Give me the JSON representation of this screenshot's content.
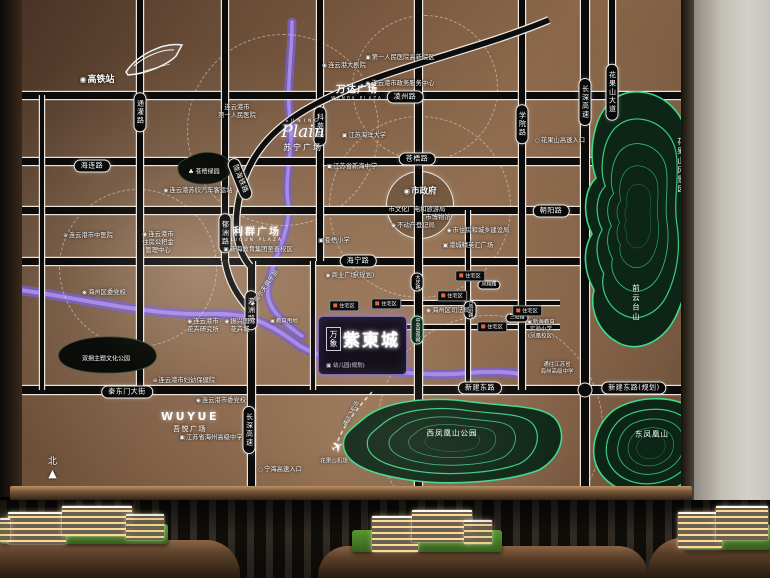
{
  "map": {
    "zone_label": "住宅区",
    "project": {
      "brand": "万象",
      "name": "紫東城",
      "note": "▣ 幼儿园(规划)"
    },
    "logos": {
      "suning": {
        "en": "SUNING",
        "script": "Plain",
        "cn": "苏宁广场"
      },
      "wanda": {
        "cn": "万达广场",
        "en": "WANDA PLAZA"
      },
      "liqun": {
        "cn": "利群广场",
        "en": "LIQUN PLAZA"
      },
      "wuyue": {
        "en": "WUYUE",
        "cn": "吾悦广场"
      }
    },
    "compass": {
      "north": "北"
    },
    "roads": {
      "h": [
        {
          "y": 95,
          "x1": 0,
          "x2": 694,
          "w": 7
        },
        {
          "y": 161,
          "x1": 0,
          "x2": 694,
          "w": 7
        },
        {
          "y": 210,
          "x1": 0,
          "x2": 694,
          "w": 7
        },
        {
          "y": 261,
          "x1": 0,
          "x2": 694,
          "w": 7
        },
        {
          "y": 390,
          "x1": 0,
          "x2": 694,
          "w": 8
        },
        {
          "y": 303,
          "x1": 396,
          "x2": 560,
          "w": 4
        },
        {
          "y": 327,
          "x1": 396,
          "x2": 560,
          "w": 4
        }
      ],
      "v": [
        {
          "x": 42,
          "y1": 95,
          "y2": 390,
          "w": 4
        },
        {
          "x": 140,
          "y1": 0,
          "y2": 390,
          "w": 6
        },
        {
          "x": 225,
          "y1": 0,
          "y2": 261,
          "w": 6
        },
        {
          "x": 251,
          "y1": 261,
          "y2": 497,
          "w": 7
        },
        {
          "x": 313,
          "y1": 261,
          "y2": 390,
          "w": 4
        },
        {
          "x": 320,
          "y1": 0,
          "y2": 261,
          "w": 6
        },
        {
          "x": 418,
          "y1": 0,
          "y2": 497,
          "w": 7
        },
        {
          "x": 468,
          "y1": 210,
          "y2": 390,
          "w": 4
        },
        {
          "x": 522,
          "y1": 0,
          "y2": 390,
          "w": 6
        },
        {
          "x": 585,
          "y1": 0,
          "y2": 497,
          "w": 8
        },
        {
          "x": 612,
          "y1": 0,
          "y2": 205,
          "w": 6
        }
      ]
    },
    "junctions": [
      {
        "x": 585,
        "y": 390
      }
    ],
    "rings": [
      {
        "cx": 283,
        "cy": 130,
        "r": 95
      },
      {
        "cx": 420,
        "cy": 207,
        "r": 90
      },
      {
        "cx": 490,
        "cy": 428,
        "r": 112
      },
      {
        "cx": 138,
        "cy": 268,
        "r": 78
      },
      {
        "cx": 425,
        "cy": 88,
        "r": 72
      }
    ],
    "gov_ring": {
      "cx": 420,
      "cy": 205,
      "r": 33
    },
    "pills": [
      {
        "t": "凌州路",
        "x": 405,
        "y": 97,
        "o": "h"
      },
      {
        "t": "海连路",
        "x": 92,
        "y": 166,
        "o": "h"
      },
      {
        "t": "苍梧路",
        "x": 417,
        "y": 159,
        "o": "h"
      },
      {
        "t": "朝阳路",
        "x": 551,
        "y": 211,
        "o": "h"
      },
      {
        "t": "海宁路",
        "x": 358,
        "y": 261,
        "o": "h"
      },
      {
        "t": "秦东门大街",
        "x": 127,
        "y": 392,
        "o": "h"
      },
      {
        "t": "新建东路",
        "x": 480,
        "y": 388,
        "o": "h"
      },
      {
        "t": "新建东路(规划)",
        "x": 634,
        "y": 388,
        "o": "h"
      },
      {
        "t": "通灌路",
        "x": 140,
        "y": 112,
        "o": "v"
      },
      {
        "t": "郁洲路",
        "x": 225,
        "y": 233,
        "o": "v"
      },
      {
        "t": "科苑路",
        "x": 320,
        "y": 126,
        "o": "v"
      },
      {
        "t": "瀛洲路",
        "x": 251,
        "y": 310,
        "o": "v"
      },
      {
        "t": "长深高速",
        "x": 249,
        "y": 430,
        "o": "v"
      },
      {
        "t": "学院路",
        "x": 522,
        "y": 124,
        "o": "v"
      },
      {
        "t": "长深高速",
        "x": 585,
        "y": 102,
        "o": "v"
      },
      {
        "t": "花果山大道",
        "x": 612,
        "y": 92,
        "o": "v"
      },
      {
        "t": "大庆路",
        "x": 417,
        "y": 282,
        "o": "v",
        "small": true
      },
      {
        "t": "中央景观带",
        "x": 417,
        "y": 330,
        "o": "v",
        "cls": "green",
        "small": true
      },
      {
        "t": "陇海铁路",
        "x": 240,
        "y": 179,
        "o": "d"
      },
      {
        "t": "凤翔路",
        "x": 489,
        "y": 285,
        "o": "h",
        "small": true
      },
      {
        "t": "三阳路",
        "x": 517,
        "y": 318,
        "o": "h",
        "small": true
      },
      {
        "t": "凤羽路",
        "x": 470,
        "y": 310,
        "o": "v",
        "small": true
      }
    ],
    "pois": [
      {
        "t": "高铁站",
        "x": 97,
        "y": 80,
        "icon": "c",
        "size": 9,
        "bold": true
      },
      {
        "t": "连云港市\n第一人民医院",
        "x": 237,
        "y": 112
      },
      {
        "t": "第一人民医院高新院区",
        "x": 400,
        "y": 58,
        "icon": "s"
      },
      {
        "t": "连云港大剧院",
        "x": 344,
        "y": 66,
        "icon": "c"
      },
      {
        "t": "连云港市政务服务中心",
        "x": 400,
        "y": 84,
        "icon": "c"
      },
      {
        "t": "江苏海洋大学",
        "x": 364,
        "y": 136,
        "icon": "s"
      },
      {
        "t": "江苏省新海中学",
        "x": 352,
        "y": 167,
        "icon": "s"
      },
      {
        "t": "市政府",
        "x": 420,
        "y": 192,
        "icon": "c",
        "size": 8.5,
        "bold": true
      },
      {
        "t": "市文化广电和旅游局",
        "x": 417,
        "y": 210
      },
      {
        "t": "市博物馆",
        "x": 438,
        "y": 218
      },
      {
        "t": "不动产登记局",
        "x": 413,
        "y": 226,
        "icon": "c"
      },
      {
        "t": "市住房和城乡建设局",
        "x": 478,
        "y": 231,
        "icon": "c"
      },
      {
        "t": "港城精英汇广场",
        "x": 468,
        "y": 246,
        "icon": "s"
      },
      {
        "t": "连云港苏欣汽车客运站",
        "x": 198,
        "y": 191,
        "icon": "c"
      },
      {
        "t": "连云港市中医院",
        "x": 88,
        "y": 236,
        "icon": "h"
      },
      {
        "t": "连云港市\n住房公积金\n管理中心",
        "x": 158,
        "y": 243,
        "icon": "c"
      },
      {
        "t": "新海教育集团至善校区",
        "x": 258,
        "y": 250,
        "icon": "s"
      },
      {
        "t": "苍梧小学",
        "x": 334,
        "y": 241,
        "icon": "s"
      },
      {
        "t": "商业广场(规划)",
        "x": 350,
        "y": 276,
        "icon": "c"
      },
      {
        "t": "教育用地",
        "x": 284,
        "y": 322,
        "icon": "s",
        "size": 5.5
      },
      {
        "t": "海州区司法局",
        "x": 448,
        "y": 311,
        "icon": "c"
      },
      {
        "t": "新海教育\n实验小学\n(凤凰校区)",
        "x": 541,
        "y": 330,
        "icon": "s",
        "size": 5.5
      },
      {
        "t": "通往江苏省\n海州高级中学",
        "x": 557,
        "y": 369,
        "size": 5.5
      },
      {
        "t": "海州区委党校",
        "x": 104,
        "y": 293,
        "icon": "c"
      },
      {
        "t": "连云港市\n花卉研究所",
        "x": 203,
        "y": 326,
        "icon": "c"
      },
      {
        "t": "振兴国际\n花卉城",
        "x": 240,
        "y": 326,
        "icon": "c"
      },
      {
        "t": "连云港市妇幼保健院",
        "x": 184,
        "y": 381,
        "icon": "h"
      },
      {
        "t": "连云港市委党校",
        "x": 221,
        "y": 401,
        "icon": "c"
      },
      {
        "t": "江苏省海州高级中学",
        "x": 211,
        "y": 438,
        "icon": "s"
      },
      {
        "t": "高尔夫俱乐部",
        "x": 265,
        "y": 289,
        "icon": "f",
        "rot": -55
      },
      {
        "t": "宁海高速入口",
        "x": 280,
        "y": 470,
        "icon": "o"
      },
      {
        "t": "花果山高速入口",
        "x": 560,
        "y": 141,
        "icon": "o"
      },
      {
        "t": "通往飞机场",
        "x": 352,
        "y": 414,
        "rot": -62,
        "size": 5.5
      },
      {
        "t": "花果山机场",
        "x": 334,
        "y": 462,
        "size": 5.5
      }
    ],
    "zones": [
      {
        "x": 344,
        "y": 306
      },
      {
        "x": 386,
        "y": 304
      },
      {
        "x": 452,
        "y": 296
      },
      {
        "x": 470,
        "y": 276
      },
      {
        "x": 492,
        "y": 327
      },
      {
        "x": 527,
        "y": 311
      }
    ],
    "mountain_labels": [
      {
        "t": "花果山风景区",
        "x": 681,
        "y": 166,
        "vert": true
      },
      {
        "t": "前云台山",
        "x": 636,
        "y": 303,
        "vert": true
      },
      {
        "t": "西凤凰山公园",
        "x": 452,
        "y": 433
      },
      {
        "t": "东凤凰山",
        "x": 652,
        "y": 434
      }
    ],
    "park_labels": [
      {
        "t": "♣ 苍梧绿园",
        "x": 204,
        "y": 171
      },
      {
        "t": "双拥主题文化公园",
        "x": 106,
        "y": 358
      }
    ]
  }
}
